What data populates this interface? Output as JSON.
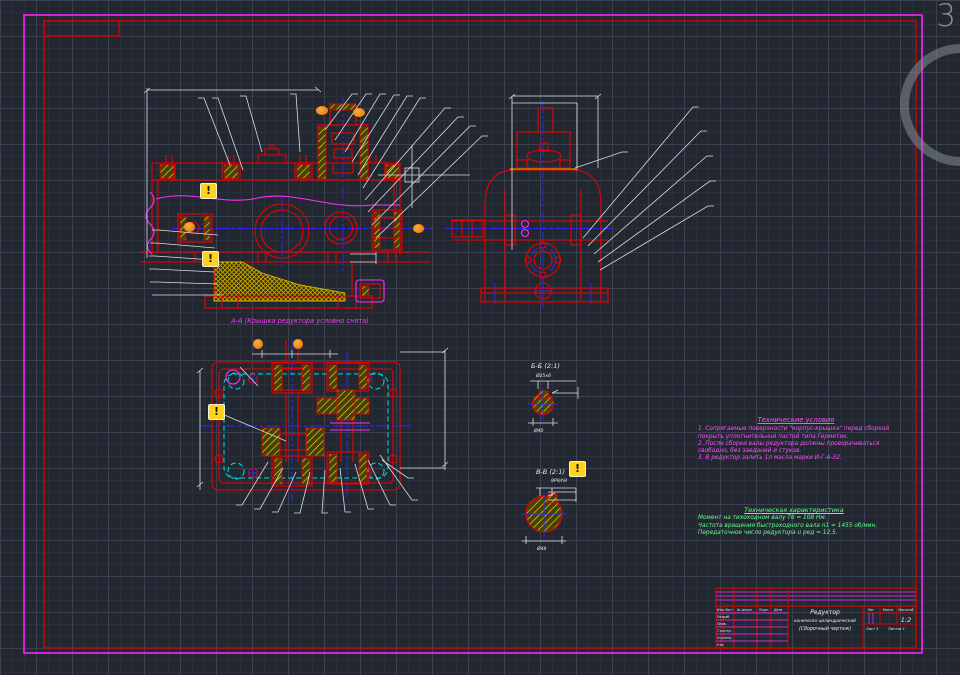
{
  "app": {
    "page_number": "3"
  },
  "warning_badge": {
    "glyph": "!"
  },
  "front_view": {
    "caption": "А-А (Крышка редуктора условно снята)"
  },
  "detail_b": {
    "label": "Б-Б (2:1)",
    "dim_top": "Ø25к6",
    "dim_bottom": "Ø40"
  },
  "detail_v": {
    "label": "В-В (2:1)",
    "dim_top": "8Р9/h9",
    "dim_bottom": "Ø48"
  },
  "tech_conditions": {
    "title": "Технические условия",
    "lines": [
      "1. Сопрягаемые поверхности \"корпус-крышка\" перед сборкой покрыть уплотнительной пастой типа Герметик.",
      "2. После сборки валы редуктора должны проворачиваться свободно, без заеданий и стуков.",
      "3. В редуктор залить 1л масла марки И-Г-А-32."
    ]
  },
  "tech_characteristics": {
    "title": "Техническая характеристика",
    "lines": [
      "Момент на тихоходном валу Т6 = 108 Нм.",
      "Частота вращения быстроходного вала n1 = 1455 об/мин.",
      "Передаточное число редуктора u ред = 12,5."
    ]
  },
  "title_block": {
    "product": "Редуктор",
    "product_type": "коническо-цилиндрический",
    "doc_type": "(Сборочный чертеж)",
    "col_lit": "Лит.",
    "col_mass": "Масса",
    "col_scale": "Масштаб",
    "scale": "1:2",
    "sheet": "Лист 1",
    "sheets": "Листов 1",
    "hdr_izm": "Изм.",
    "hdr_list": "Лист",
    "hdr_doc": "№ докум.",
    "hdr_sign": "Подп.",
    "hdr_date": "Дата",
    "row_razrab": "Разраб.",
    "row_prov": "Пров.",
    "row_tkontr": "Т.контр.",
    "row_nkontr": "Н.контр.",
    "row_utv": "Утв."
  }
}
